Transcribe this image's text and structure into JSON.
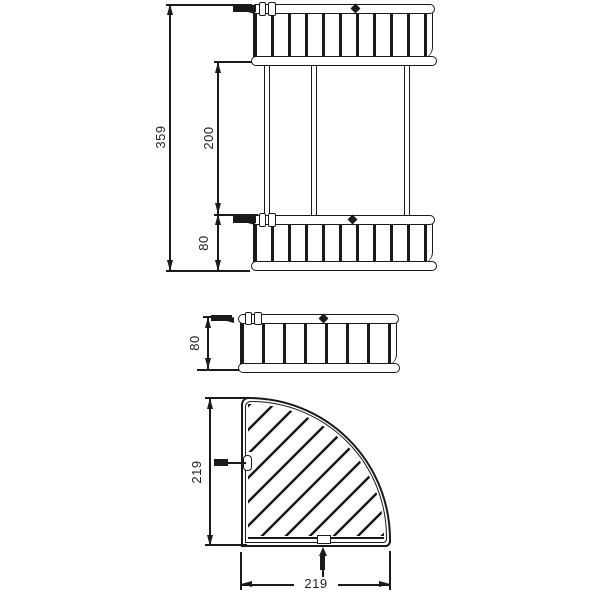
{
  "page": {
    "background": "#ffffff",
    "line_color": "#1a1a1a",
    "description": "Dimensioned technical drawing of a double-tier corner wire basket: front elevation, side elevation and quarter-circle plan view"
  },
  "drawing": {
    "front_view": {
      "dim_total_height": "359",
      "dim_tier_spacing": "200",
      "dim_tier_height": "80"
    },
    "side_view": {
      "dim_height": "80"
    },
    "plan_view": {
      "dim_depth": "219",
      "dim_width": "219"
    }
  }
}
